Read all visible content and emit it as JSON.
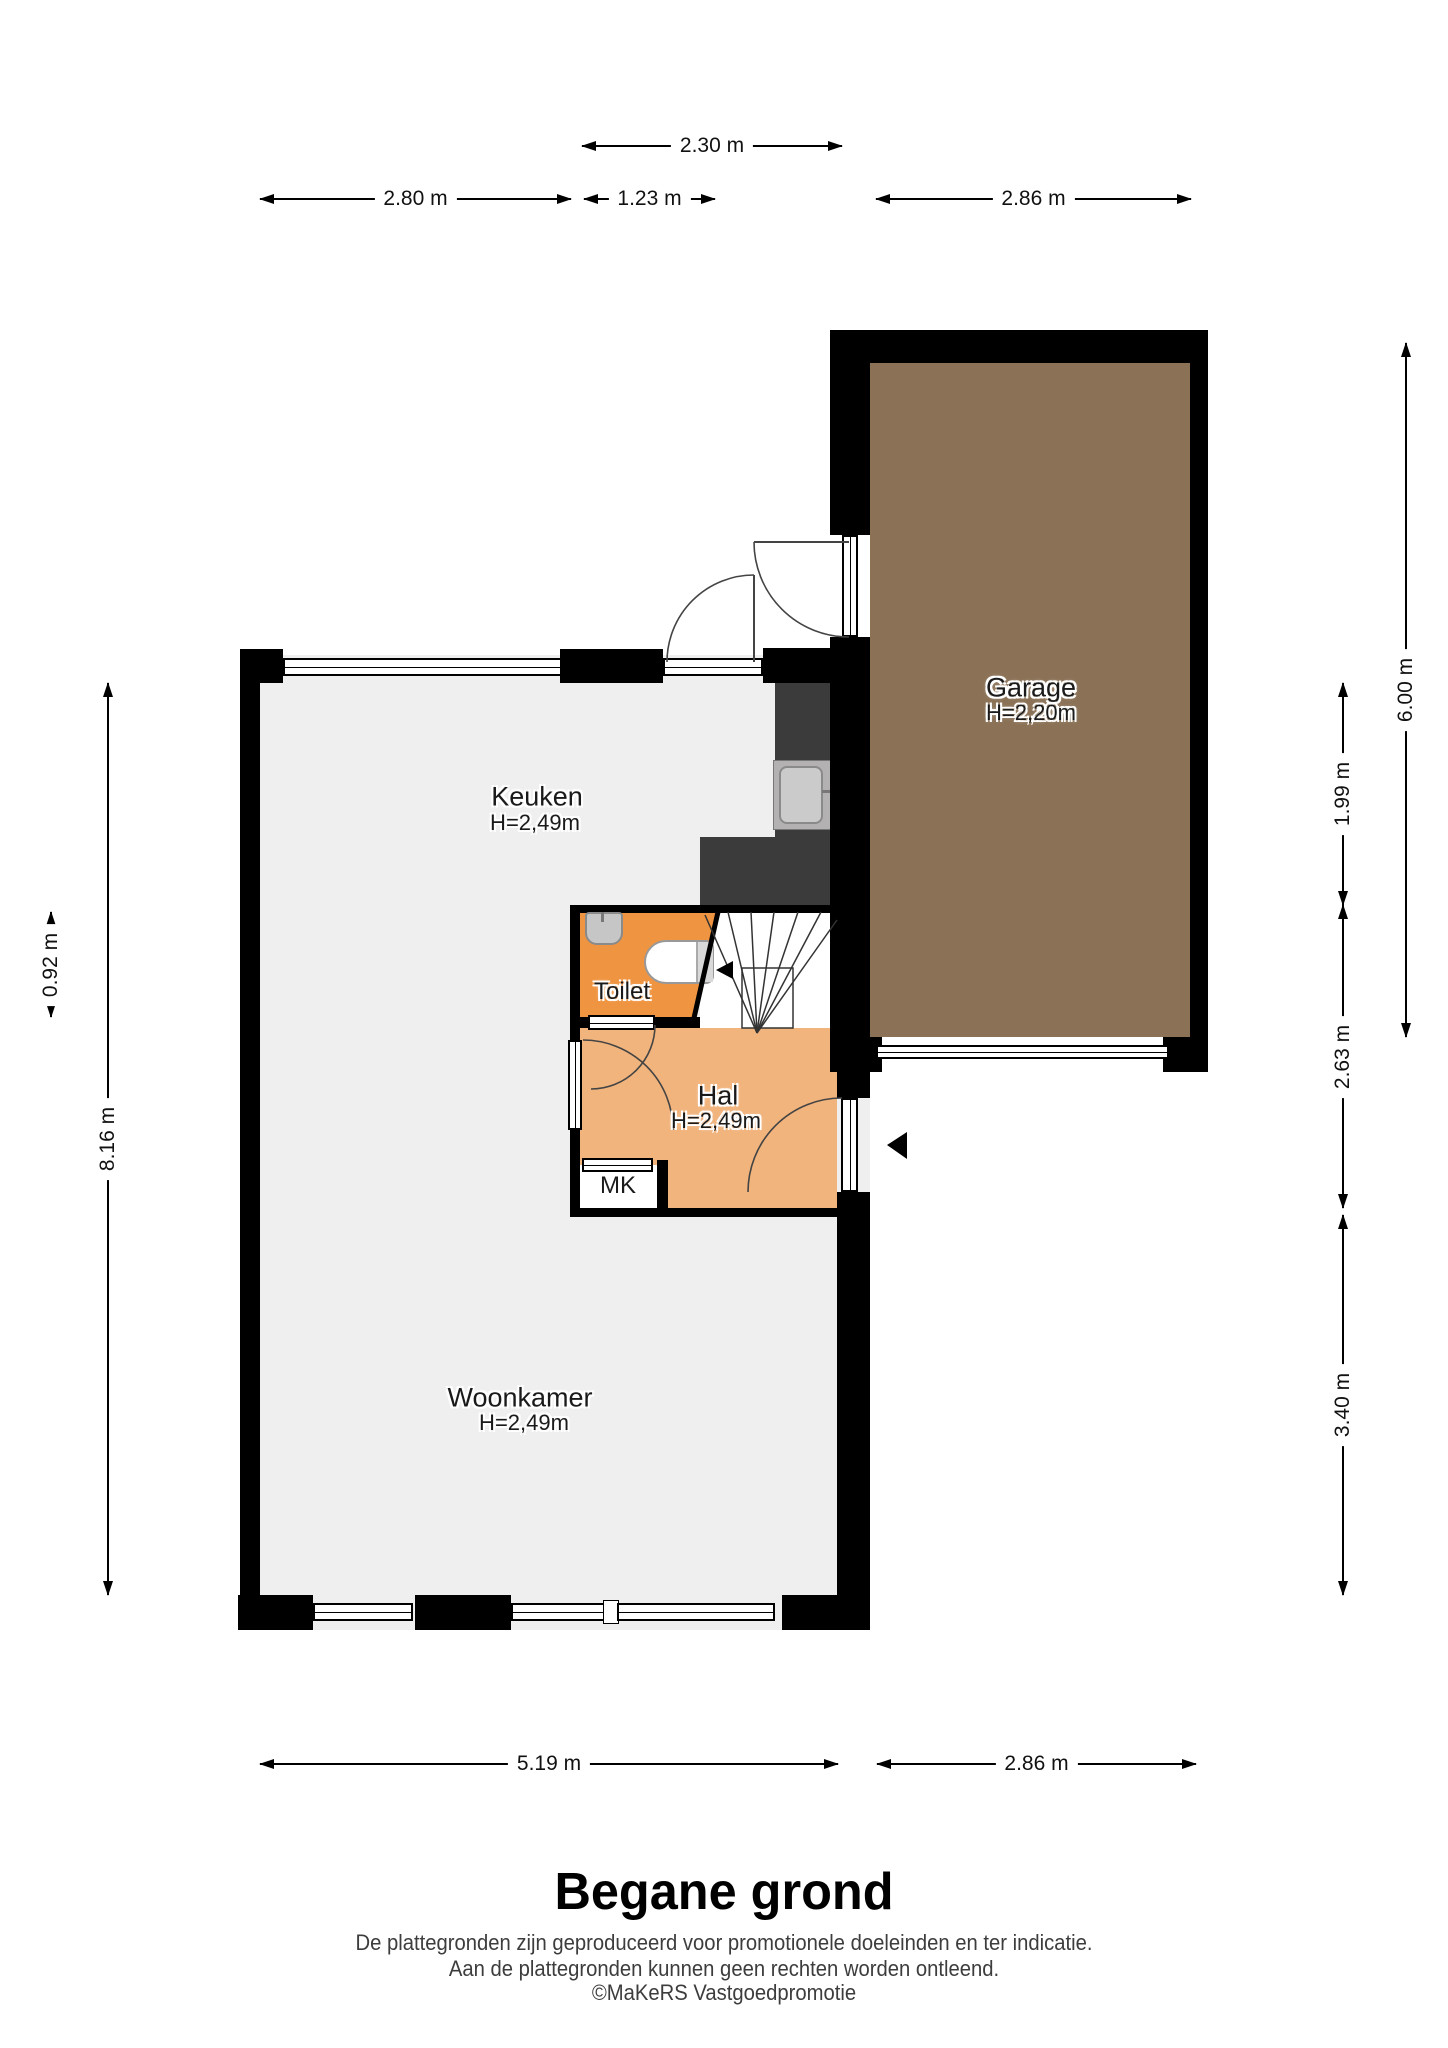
{
  "plan": {
    "title": "Begane grond",
    "disclaimer": {
      "line1": "De plattegronden zijn geproduceerd voor promotionele doeleinden en ter indicatie.",
      "line2": "Aan de plattegronden kunnen geen rechten worden ontleend.",
      "line3": "©MaKeRS Vastgoedpromotie"
    },
    "rooms": {
      "keuken": {
        "name": "Keuken",
        "ceiling": "H=2,49m"
      },
      "garage": {
        "name": "Garage",
        "ceiling": "H=2,20m"
      },
      "toilet": {
        "name": "Toilet"
      },
      "hal": {
        "name": "Hal",
        "ceiling": "H=2,49m"
      },
      "mk": {
        "name": "MK"
      },
      "woonkamer": {
        "name": "Woonkamer",
        "ceiling": "H=2,49m"
      }
    },
    "dimensions": {
      "top": [
        {
          "label": "2.30 m"
        },
        {
          "label": "2.80 m"
        },
        {
          "label": "1.23 m"
        },
        {
          "label": "2.86 m"
        }
      ],
      "left": [
        {
          "label": "0.92 m"
        },
        {
          "label": "8.16 m"
        }
      ],
      "right": [
        {
          "label": "1.99 m"
        },
        {
          "label": "2.63 m"
        },
        {
          "label": "3.40 m"
        },
        {
          "label": "6.00 m"
        }
      ],
      "bottom": [
        {
          "label": "5.19 m"
        },
        {
          "label": "2.86 m"
        }
      ]
    },
    "colors": {
      "floor": "#efefef",
      "garage_floor": "#8b7257",
      "hal_floor": "#f1b47d",
      "toilet_floor": "#ef9440",
      "wall": "#000000",
      "counter": "#3b3b3b"
    }
  }
}
